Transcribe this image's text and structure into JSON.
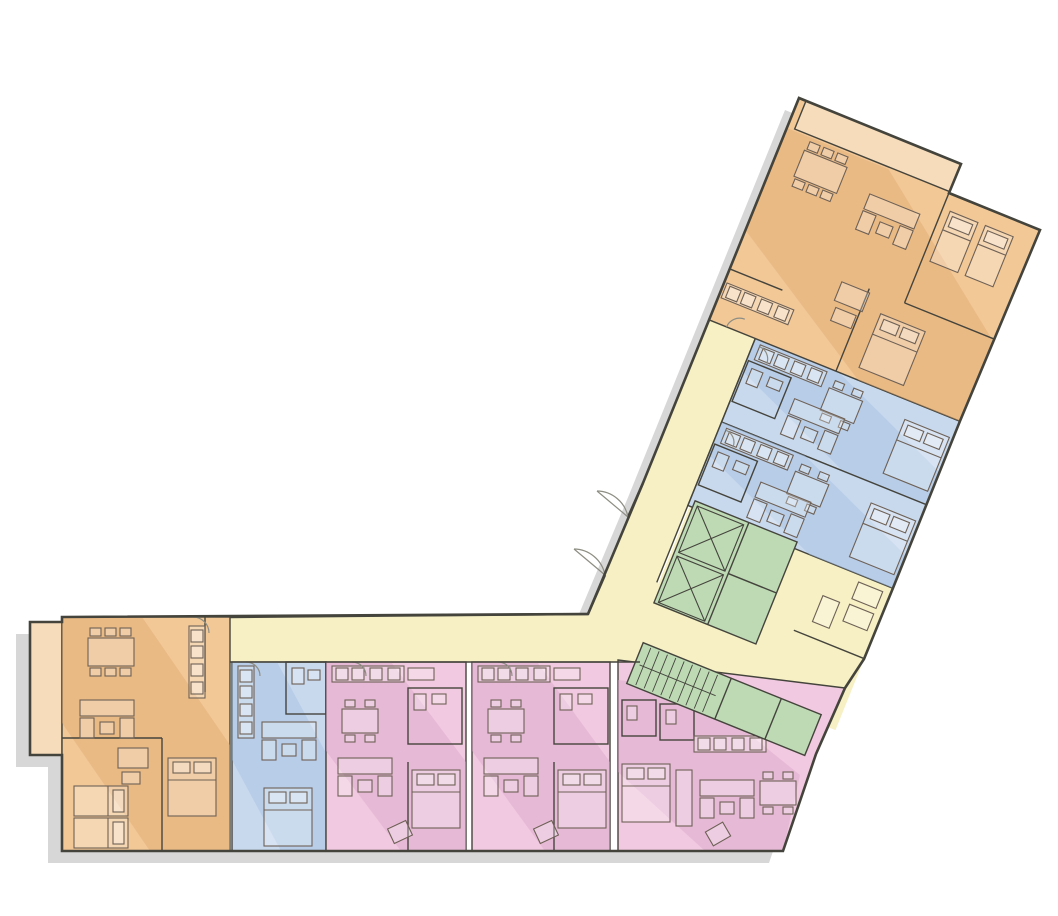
{
  "palette": {
    "background": "#ffffff",
    "shadow": "#d7d7d7",
    "wall": "#45443c",
    "furniture_line": "#6e6156",
    "unit_orange": "#f2c897",
    "unit_orange_shade": "#dfa96f",
    "balcony_orange": "#f6dcba",
    "unit_blue": "#c8d9ee",
    "unit_blue_shade": "#a4bfe0",
    "corridor_yellow": "#f6f0c4",
    "corridor_yellow_shade": "#e9df92",
    "core_green": "#bddab5",
    "core_green_shade": "#9ec796",
    "unit_pink": "#f1c9e0",
    "unit_pink_shade": "#d9a8c9"
  },
  "plan": {
    "kind": "residential-floor-plan",
    "wings": [
      {
        "name": "west-wing",
        "orientation": "horizontal"
      },
      {
        "name": "northeast-wing",
        "orientation": "angled-22-degrees"
      }
    ],
    "zones": [
      {
        "id": "unit-orange-northeast",
        "use": "apartment",
        "color": "unit_orange",
        "features": [
          "roof-terrace",
          "dining",
          "living",
          "twin-bedroom",
          "double-bedroom",
          "bathrooms"
        ]
      },
      {
        "id": "unit-blue-upper",
        "use": "apartment",
        "color": "unit_blue",
        "features": [
          "kitchen",
          "dining",
          "living",
          "bedroom",
          "bathroom"
        ]
      },
      {
        "id": "unit-blue-lower",
        "use": "apartment",
        "color": "unit_blue",
        "features": [
          "kitchen",
          "dining",
          "living",
          "bedroom",
          "bathroom"
        ]
      },
      {
        "id": "elevator-core",
        "use": "circulation",
        "color": "core_green",
        "elevator_count": 2
      },
      {
        "id": "stair-core",
        "use": "circulation",
        "color": "core_green"
      },
      {
        "id": "corridor-and-lobby",
        "use": "circulation",
        "color": "corridor_yellow",
        "features": [
          "main-entrance-double-door",
          "seating-nook"
        ]
      },
      {
        "id": "unit-pink-corner",
        "use": "apartment",
        "color": "unit_pink",
        "features": [
          "kitchen",
          "dining",
          "living",
          "bedroom",
          "bathrooms"
        ]
      },
      {
        "id": "unit-pink-a",
        "use": "apartment",
        "color": "unit_pink",
        "features": [
          "kitchen",
          "dining",
          "living",
          "bedroom",
          "bathroom"
        ]
      },
      {
        "id": "unit-pink-b",
        "use": "apartment",
        "color": "unit_pink",
        "features": [
          "kitchen",
          "dining",
          "living",
          "bedroom",
          "bathroom"
        ]
      },
      {
        "id": "unit-blue-studio",
        "use": "apartment",
        "color": "unit_blue",
        "features": [
          "kitchen",
          "living",
          "bed",
          "bathroom"
        ]
      },
      {
        "id": "unit-orange-west",
        "use": "apartment",
        "color": "unit_orange",
        "features": [
          "balcony",
          "dining",
          "living",
          "twin-bedroom",
          "double-bedroom",
          "bathroom"
        ]
      }
    ]
  }
}
